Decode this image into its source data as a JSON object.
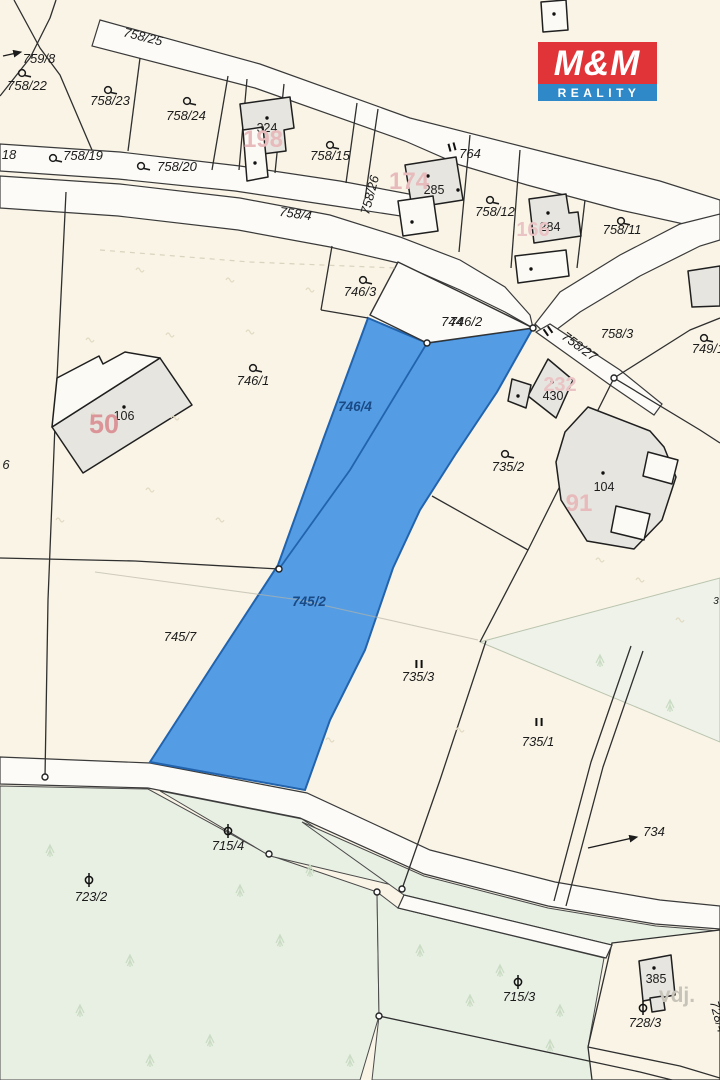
{
  "branding": {
    "logo_top": "M&M",
    "logo_bottom": "REALITY",
    "logo_red": "#e13438",
    "logo_blue": "#2f89c9"
  },
  "map": {
    "colors": {
      "background": "#f9f4e6",
      "road": "#fcfbf7",
      "forest": "#e8efe3",
      "forest_light": "#eef2e8",
      "highlight_fill": "#549de5",
      "highlight_border": "#2263ae",
      "highlight_text": "#1a4a85",
      "boundary": "#2f2f2f",
      "label": "#1c1c1c",
      "faded_red": "#e7babc",
      "faded_red_strong": "#db9498",
      "gray_label": "#c8c3b8"
    },
    "labels": [
      {
        "id": "759-8",
        "t": "759/8",
        "x": 39,
        "y": 63,
        "k": "parcel"
      },
      {
        "id": "758-22",
        "t": "758/22",
        "x": 27,
        "y": 90,
        "k": "parcel"
      },
      {
        "id": "758-23",
        "t": "758/23",
        "x": 110,
        "y": 105,
        "k": "parcel"
      },
      {
        "id": "758-24",
        "t": "758/24",
        "x": 186,
        "y": 120,
        "k": "parcel"
      },
      {
        "id": "758-15",
        "t": "758/15",
        "x": 330,
        "y": 160,
        "k": "parcel"
      },
      {
        "id": "718",
        "t": "18",
        "x": 9,
        "y": 159,
        "k": "parcel"
      },
      {
        "id": "758-19",
        "t": "758/19",
        "x": 83,
        "y": 160,
        "k": "parcel"
      },
      {
        "id": "758-20",
        "t": "758/20",
        "x": 177,
        "y": 171,
        "k": "parcel"
      },
      {
        "id": "758-25",
        "t": "758/25",
        "x": 142,
        "y": 41,
        "rot": 14,
        "k": "parcel"
      },
      {
        "id": "758-4",
        "t": "758/4",
        "x": 295,
        "y": 218,
        "rot": 8,
        "k": "parcel"
      },
      {
        "id": "764",
        "t": "764",
        "x": 470,
        "y": 158,
        "k": "parcel"
      },
      {
        "id": "758-26",
        "t": "758/26",
        "x": 374,
        "y": 196,
        "rot": -75,
        "k": "parcel"
      },
      {
        "id": "758-12",
        "t": "758/12",
        "x": 495,
        "y": 216,
        "k": "parcel"
      },
      {
        "id": "758-11",
        "t": "758/11",
        "x": 622,
        "y": 234,
        "k": "parcel"
      },
      {
        "id": "746-3",
        "t": "746/3",
        "x": 360,
        "y": 296,
        "k": "parcel"
      },
      {
        "id": "744",
        "t": "744",
        "x": 452,
        "y": 326,
        "k": "parcel"
      },
      {
        "id": "746-2",
        "t": "746/2",
        "x": 466,
        "y": 326,
        "k": "parcel"
      },
      {
        "id": "758-27",
        "t": "758/27",
        "x": 577,
        "y": 350,
        "rot": 36,
        "k": "parcel"
      },
      {
        "id": "758-3",
        "t": "758/3",
        "x": 617,
        "y": 338,
        "k": "parcel"
      },
      {
        "id": "749-1",
        "t": "749/1",
        "x": 708,
        "y": 353,
        "k": "parcel"
      },
      {
        "id": "746-1",
        "t": "746/1",
        "x": 253,
        "y": 385,
        "k": "parcel"
      },
      {
        "id": "746-4",
        "t": "746/4",
        "x": 355,
        "y": 411,
        "k": "blue"
      },
      {
        "id": "735-2",
        "t": "735/2",
        "x": 508,
        "y": 471,
        "k": "parcel"
      },
      {
        "id": "6",
        "t": "6",
        "x": 6,
        "y": 469,
        "k": "parcel"
      },
      {
        "id": "745-2",
        "t": "745/2",
        "x": 309,
        "y": 606,
        "k": "blue"
      },
      {
        "id": "3",
        "t": "3",
        "x": 716,
        "y": 604,
        "k": "parcel-small"
      },
      {
        "id": "745-7",
        "t": "745/7",
        "x": 180,
        "y": 641,
        "k": "parcel"
      },
      {
        "id": "735-3",
        "t": "735/3",
        "x": 418,
        "y": 681,
        "k": "parcel"
      },
      {
        "id": "735-1",
        "t": "735/1",
        "x": 538,
        "y": 746,
        "k": "parcel"
      },
      {
        "id": "734",
        "t": "734",
        "x": 654,
        "y": 836,
        "k": "parcel"
      },
      {
        "id": "715-4",
        "t": "715/4",
        "x": 228,
        "y": 850,
        "k": "parcel"
      },
      {
        "id": "723-2",
        "t": "723/2",
        "x": 91,
        "y": 901,
        "k": "parcel"
      },
      {
        "id": "715-3",
        "t": "715/3",
        "x": 519,
        "y": 1001,
        "k": "parcel"
      },
      {
        "id": "728-3",
        "t": "728/3",
        "x": 645,
        "y": 1027,
        "k": "parcel"
      },
      {
        "id": "728-4",
        "t": "728/4",
        "x": 714,
        "y": 1018,
        "rot": 75,
        "k": "parcel"
      },
      {
        "id": "b324",
        "t": "324",
        "x": 267,
        "y": 132,
        "k": "building"
      },
      {
        "id": "b285",
        "t": "285",
        "x": 434,
        "y": 194,
        "k": "building"
      },
      {
        "id": "b284",
        "t": "284",
        "x": 550,
        "y": 231,
        "k": "building"
      },
      {
        "id": "b430",
        "t": "430",
        "x": 553,
        "y": 400,
        "k": "building"
      },
      {
        "id": "b104",
        "t": "104",
        "x": 604,
        "y": 491,
        "k": "building"
      },
      {
        "id": "b106",
        "t": "106",
        "x": 124,
        "y": 420,
        "k": "building"
      },
      {
        "id": "b385",
        "t": "385",
        "x": 656,
        "y": 983,
        "k": "building"
      },
      {
        "id": "f198",
        "t": "198",
        "x": 263,
        "y": 147,
        "k": "faded"
      },
      {
        "id": "f174",
        "t": "174",
        "x": 409,
        "y": 189,
        "k": "faded"
      },
      {
        "id": "f166",
        "t": "166",
        "x": 533,
        "y": 236,
        "k": "faded2"
      },
      {
        "id": "f232",
        "t": "232",
        "x": 560,
        "y": 391,
        "k": "faded2"
      },
      {
        "id": "f91",
        "t": "91",
        "x": 579,
        "y": 511,
        "k": "faded"
      },
      {
        "id": "f50",
        "t": "50",
        "x": 104,
        "y": 433,
        "k": "faded-strong"
      },
      {
        "id": "vdj",
        "t": "vdj.",
        "x": 677,
        "y": 1002,
        "k": "gray"
      }
    ],
    "symbols": [
      {
        "type": "garden",
        "x": 22,
        "y": 73
      },
      {
        "type": "garden",
        "x": 108,
        "y": 90
      },
      {
        "type": "garden",
        "x": 187,
        "y": 101
      },
      {
        "type": "garden",
        "x": 330,
        "y": 145
      },
      {
        "type": "garden",
        "x": 53,
        "y": 158
      },
      {
        "type": "garden",
        "x": 141,
        "y": 166
      },
      {
        "type": "garden",
        "x": 490,
        "y": 200
      },
      {
        "type": "garden",
        "x": 621,
        "y": 221
      },
      {
        "type": "garden",
        "x": 363,
        "y": 280
      },
      {
        "type": "garden",
        "x": 253,
        "y": 368
      },
      {
        "type": "garden",
        "x": 704,
        "y": 338
      },
      {
        "type": "garden",
        "x": 505,
        "y": 454
      },
      {
        "type": "forest",
        "x": 228,
        "y": 831
      },
      {
        "type": "forest",
        "x": 89,
        "y": 880
      },
      {
        "type": "forest",
        "x": 518,
        "y": 982
      },
      {
        "type": "forest",
        "x": 643,
        "y": 1008
      },
      {
        "type": "parallel",
        "x": 452,
        "y": 147,
        "rot": -15
      },
      {
        "type": "parallel",
        "x": 548,
        "y": 331,
        "rot": -35
      },
      {
        "type": "parallel",
        "x": 419,
        "y": 664,
        "rot": 0
      },
      {
        "type": "parallel",
        "x": 539,
        "y": 722,
        "rot": 0
      },
      {
        "type": "vertex",
        "x": 45,
        "y": 777
      },
      {
        "type": "vertex",
        "x": 279,
        "y": 569
      },
      {
        "type": "vertex",
        "x": 427,
        "y": 343
      },
      {
        "type": "vertex",
        "x": 533,
        "y": 328
      },
      {
        "type": "vertex",
        "x": 614,
        "y": 378
      },
      {
        "type": "vertex",
        "x": 377,
        "y": 892
      },
      {
        "type": "vertex",
        "x": 402,
        "y": 889
      },
      {
        "type": "vertex",
        "x": 379,
        "y": 1016
      },
      {
        "type": "vertex",
        "x": 269,
        "y": 854
      },
      {
        "type": "dot",
        "x": 267,
        "y": 118
      },
      {
        "type": "dot",
        "x": 255,
        "y": 163
      },
      {
        "type": "dot",
        "x": 428,
        "y": 176
      },
      {
        "type": "dot",
        "x": 458,
        "y": 190
      },
      {
        "type": "dot",
        "x": 412,
        "y": 222
      },
      {
        "type": "dot",
        "x": 548,
        "y": 213
      },
      {
        "type": "dot",
        "x": 531,
        "y": 269
      },
      {
        "type": "dot",
        "x": 554,
        "y": 14
      },
      {
        "type": "dot",
        "x": 552,
        "y": 382
      },
      {
        "type": "dot",
        "x": 518,
        "y": 396
      },
      {
        "type": "dot",
        "x": 603,
        "y": 473
      },
      {
        "type": "dot",
        "x": 124,
        "y": 407
      },
      {
        "type": "dot",
        "x": 654,
        "y": 968
      },
      {
        "type": "arrow",
        "x1": 3,
        "y1": 56,
        "x2": 21,
        "y2": 52
      },
      {
        "type": "arrow",
        "x1": 588,
        "y1": 848,
        "x2": 637,
        "y2": 837
      }
    ]
  }
}
